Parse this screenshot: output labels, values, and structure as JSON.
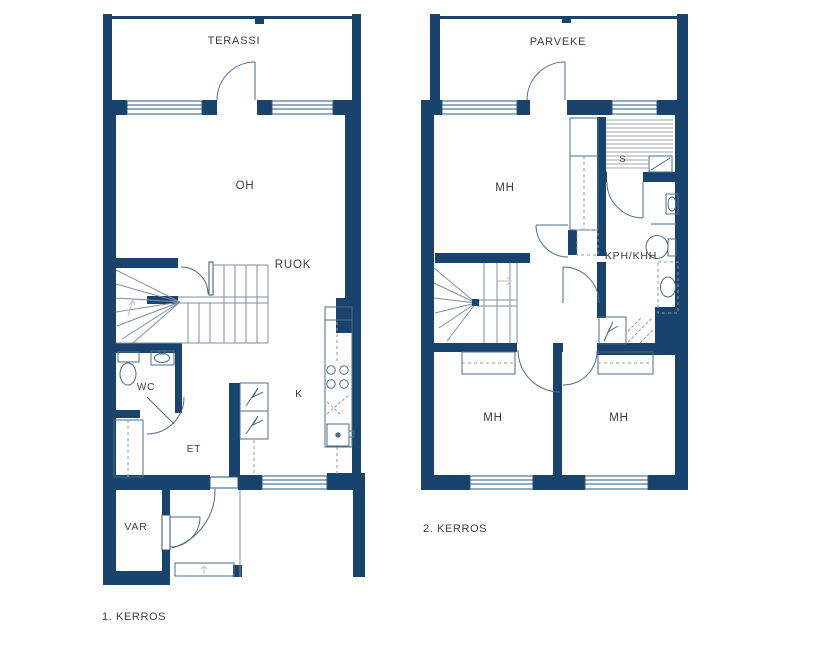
{
  "palette": {
    "wall": "#17436c",
    "thin_line": "#2a547c",
    "fixture_line": "#4a6c8c",
    "stair_line": "#7d8fa3",
    "dash_line": "#8d9aa8",
    "bench_line": "#9aa4ad",
    "arrow": "#c3c9ce",
    "text": "#3c3c3c",
    "background": "#ffffff"
  },
  "floor1": {
    "caption": "1. KERROS",
    "rooms": {
      "terrace": "TERASSI",
      "living": "OH",
      "dining": "RUOK",
      "wc": "WC",
      "hall": "ET",
      "storage": "VAR",
      "kitchen": "K"
    }
  },
  "floor2": {
    "caption": "2. KERROS",
    "rooms": {
      "balcony": "PARVEKE",
      "bedroom_top": "MH",
      "sauna": "S",
      "bathroom": "KPH/KHH",
      "bedroom_left": "MH",
      "bedroom_right": "MH"
    }
  }
}
